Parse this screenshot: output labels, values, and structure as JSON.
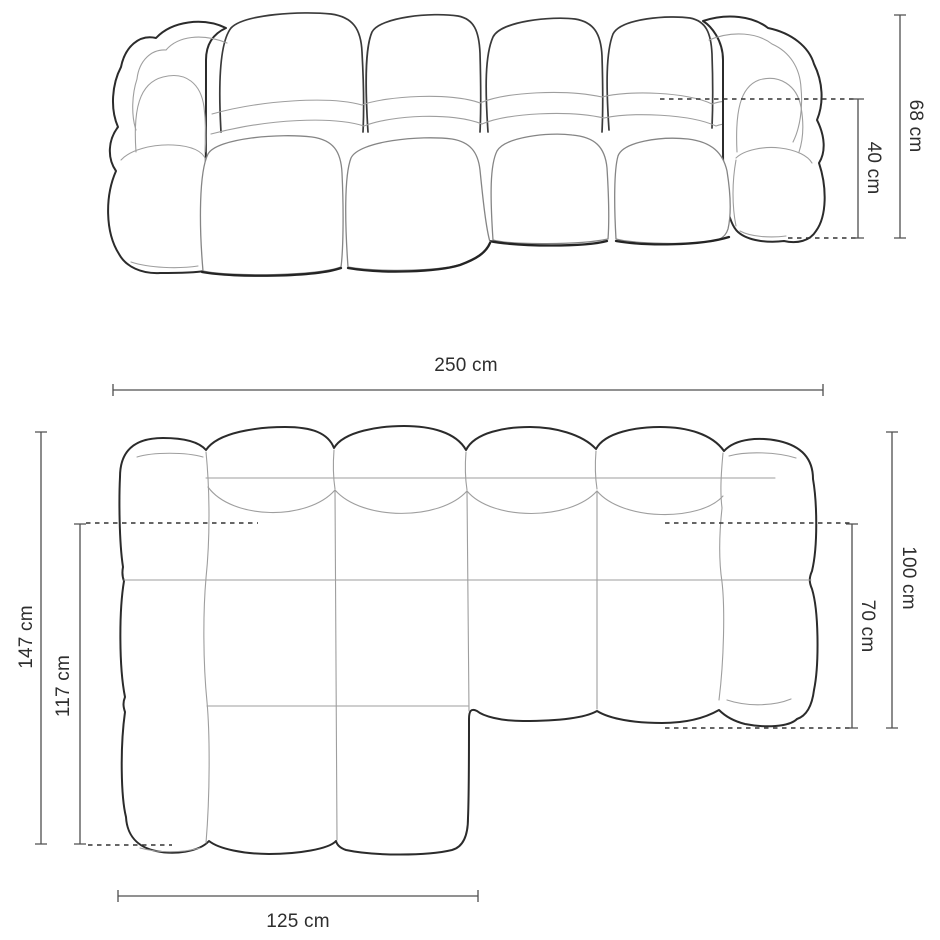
{
  "diagram": {
    "colors": {
      "background": "#ffffff",
      "outline": "#2b2b2b",
      "crease": "#9e9e9e",
      "dimension_line": "#4f4f4f",
      "dimension_text": "#2e2e2e"
    },
    "front_view": {
      "dims": {
        "total_height": "68 cm",
        "seat_height": "40 cm"
      }
    },
    "top_view": {
      "dims": {
        "total_width": "250 cm",
        "total_depth_left": "147 cm",
        "chaise_depth": "117 cm",
        "total_depth_right": "100 cm",
        "seat_depth": "70 cm",
        "chaise_width": "125 cm"
      }
    }
  }
}
